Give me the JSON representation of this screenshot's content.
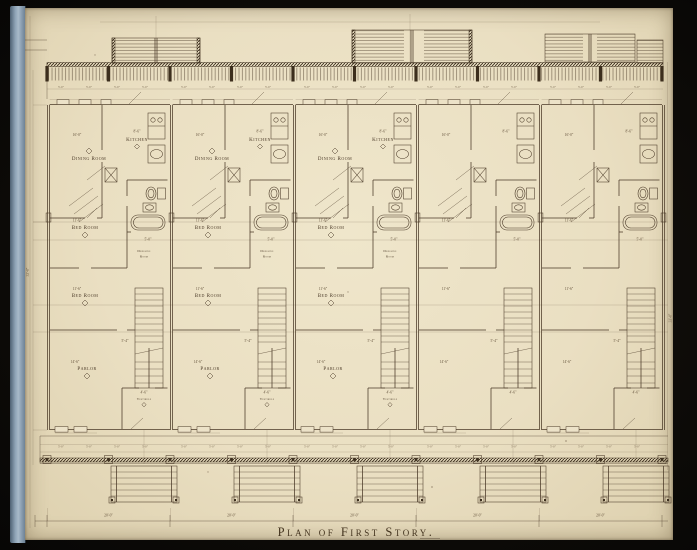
{
  "title": "Plan of First Story.",
  "rooms": {
    "dining": "Dining Room",
    "kitchen": "Kitchen",
    "bed": "Bed Room",
    "parlor": "Parlor",
    "vestibule": "Vestibule",
    "dressing": "Dressing",
    "dressing2": "Room"
  },
  "dims": {
    "dining": "16'-0\"",
    "kitchen": "8'-6\"",
    "bed": "11'-6\"",
    "parlor": "14'-6\"",
    "vestibule": "4'-6\"",
    "stair": "5'-4\"",
    "tub": "5'-0\"",
    "porch_bay": "5'-0\"",
    "unit_width": "20'-0\"",
    "lot_depth": "33'-0\""
  },
  "bottom_dims": [
    "20'-0\"",
    "20'-0\"",
    "20'-0\"",
    "20'-0\"",
    "20'-0\""
  ],
  "units": [
    {
      "labeled": true
    },
    {
      "labeled": true
    },
    {
      "labeled": true
    },
    {
      "labeled": false
    },
    {
      "labeled": false
    }
  ],
  "colors": {
    "paper": "#eadfc2",
    "ink": "#4a3927",
    "photo_edge": "#0c0a07",
    "book_edge_blue": "#8ea3b6"
  }
}
